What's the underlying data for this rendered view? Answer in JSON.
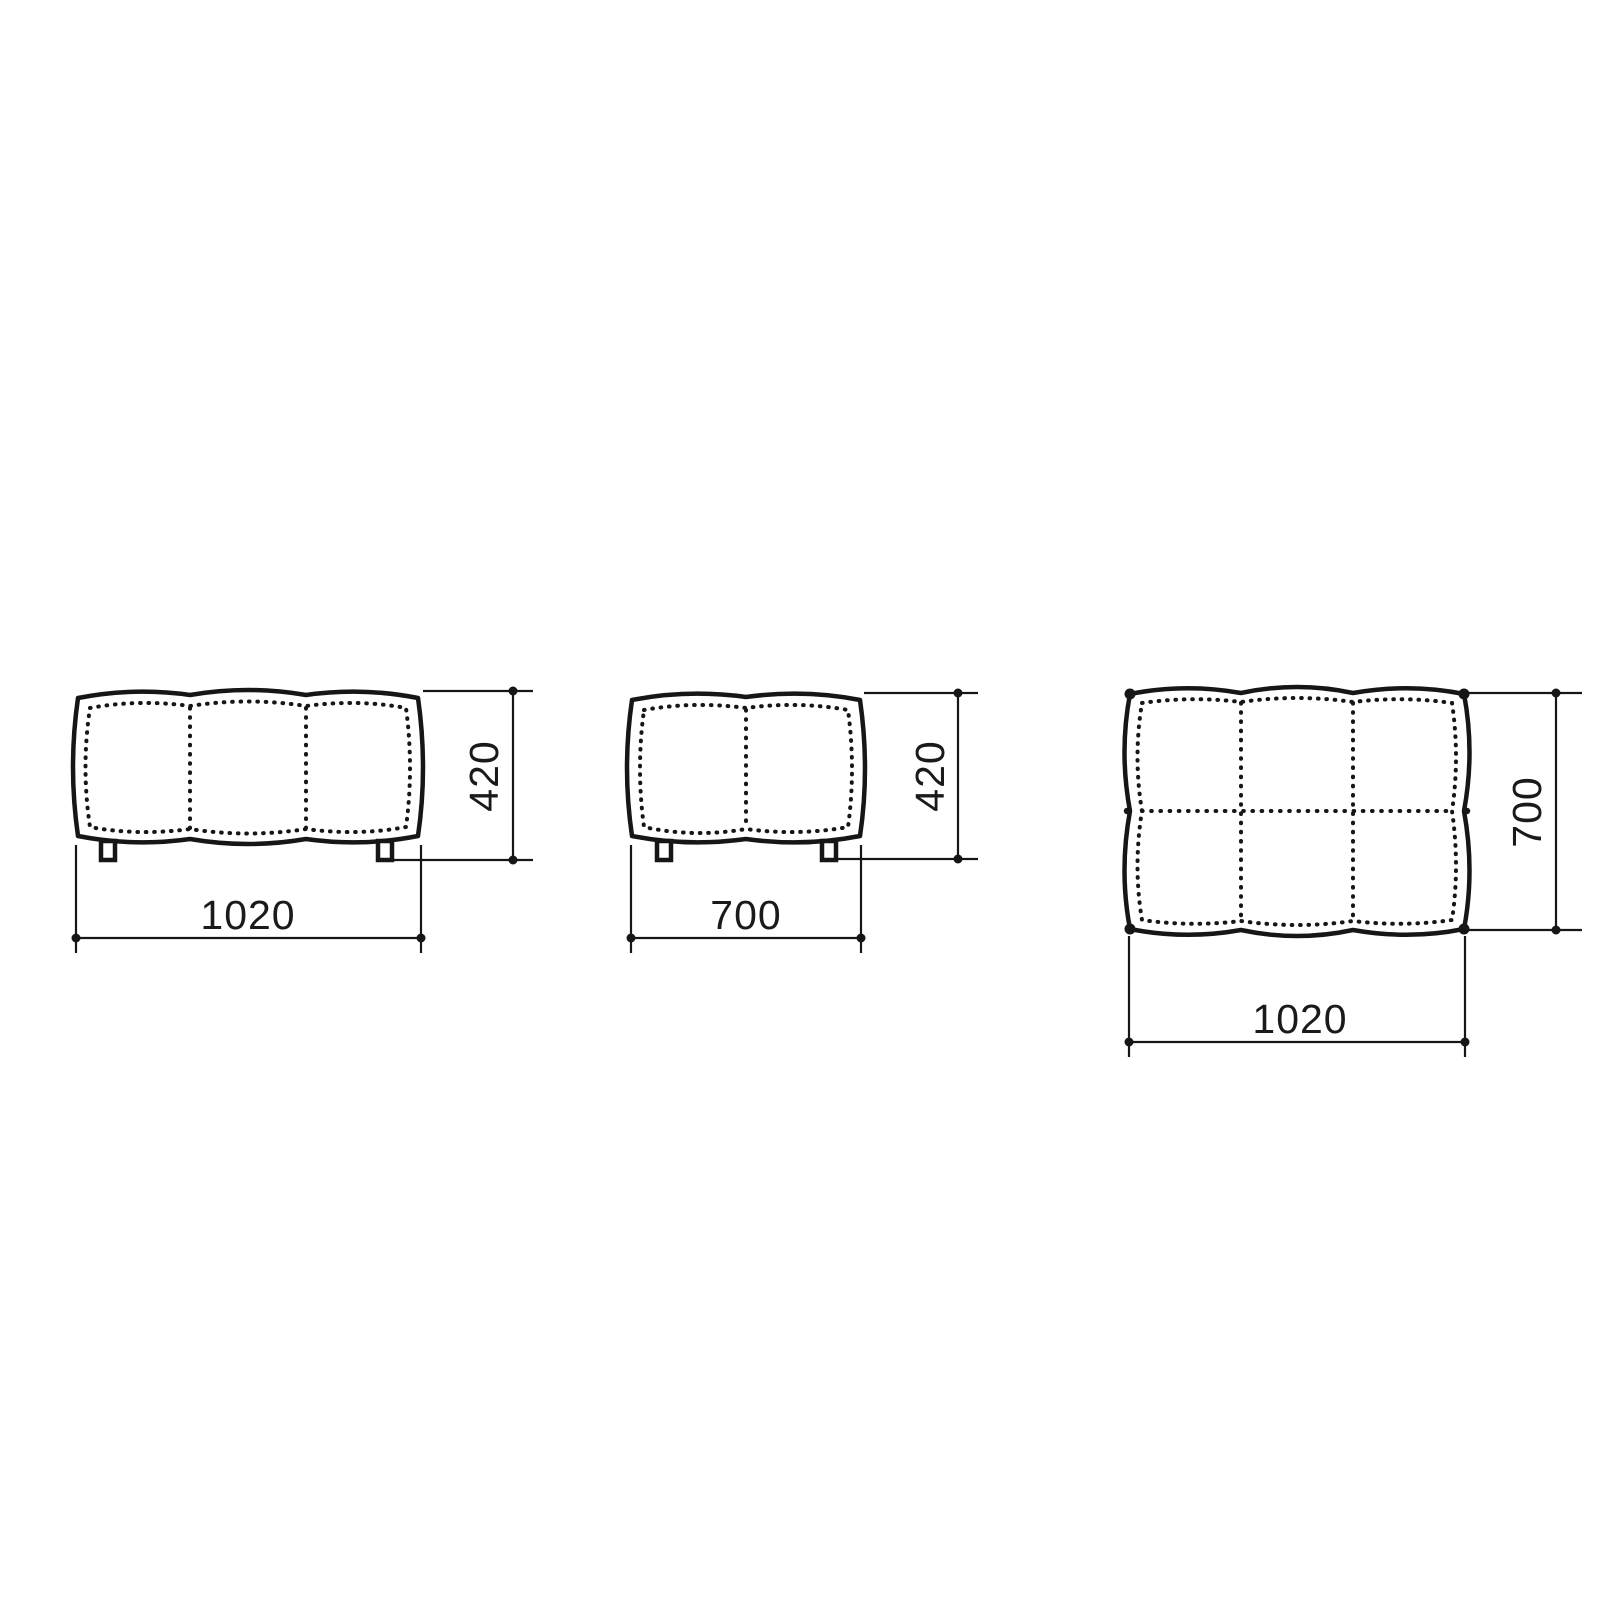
{
  "drawing": {
    "kind": "furniture dimensional drawing",
    "subject": "tufted ottoman / bench pouf",
    "background_color": "#ffffff",
    "line_color": "#161616",
    "views": [
      {
        "id": "front-elevation",
        "width_label": "1020",
        "height_label": "420",
        "panels": 3,
        "legs": 2
      },
      {
        "id": "side-elevation",
        "width_label": "700",
        "height_label": "420",
        "panels": 2,
        "legs": 2
      },
      {
        "id": "top-plan",
        "width_label": "1020",
        "depth_label": "700",
        "panels_x": 3,
        "panels_y": 2
      }
    ]
  }
}
